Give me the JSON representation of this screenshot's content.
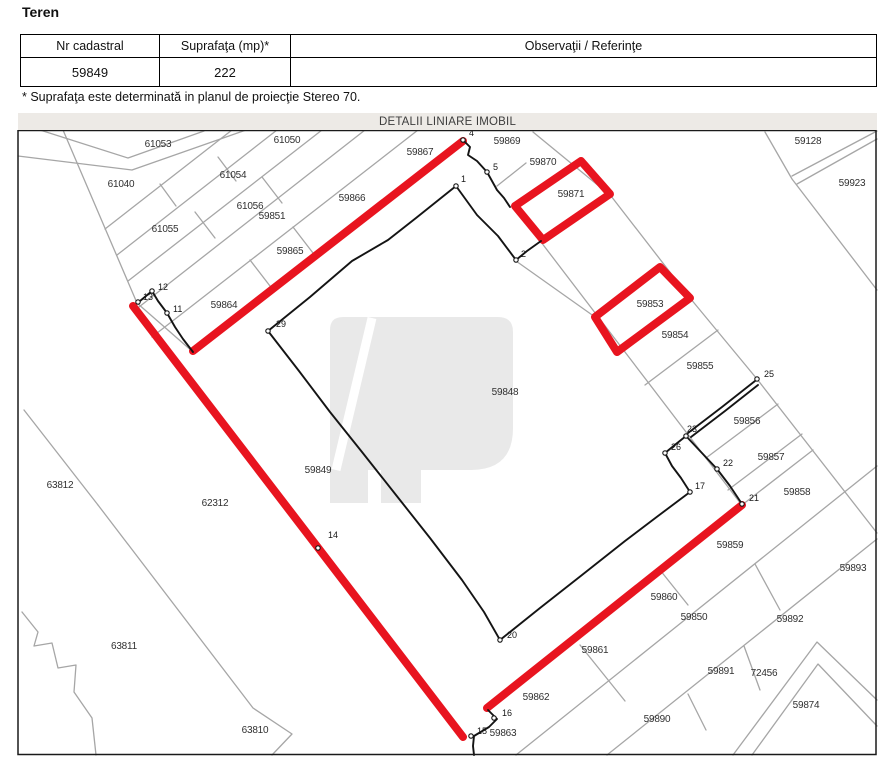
{
  "page": {
    "heading": "Teren"
  },
  "table": {
    "headers": [
      "Nr cadastral",
      "Suprafaţa (mp)*",
      "Observaţii / Referinţe"
    ],
    "row": {
      "nr_cadastral": "59849",
      "suprafata": "222",
      "observatii": ""
    }
  },
  "footnote": "* Suprafaţa este determinată in planul de proiecţie Stereo 70.",
  "map": {
    "title": "DETALII LINIARE IMOBIL",
    "colors": {
      "highlight_red": "#e8141f",
      "parcel_gray": "#a6a6a6",
      "boundary_black": "#141414",
      "label_color": "#303030",
      "watermark_gray": "#e9e9e9",
      "titlebar_bg": "#edeae6",
      "frame_black": "#1a1a1a"
    },
    "frame": {
      "x": 18,
      "y": 130,
      "w": 858,
      "h": 624
    },
    "watermark_path": "M330 503 L330 330 Q330 317 343 317 L498 317 Q513 317 513 332 L513 428 Q513 470 471 470 L421 470 L421 503 L381 503 L381 470 L368 470 L368 503 Z",
    "watermark_slash": [
      [
        336,
        470
      ],
      [
        372,
        318
      ]
    ],
    "gray_polylines": [
      [
        [
          18,
          156
        ],
        [
          132,
          170
        ],
        [
          246,
          130
        ]
      ],
      [
        [
          40,
          130
        ],
        [
          128,
          158
        ],
        [
          204,
          131
        ]
      ],
      [
        [
          63,
          130
        ],
        [
          137,
          303
        ],
        [
          193,
          352
        ]
      ],
      [
        [
          105,
          229
        ],
        [
          232,
          130
        ]
      ],
      [
        [
          117,
          255
        ],
        [
          277,
          130
        ]
      ],
      [
        [
          128,
          281
        ],
        [
          322,
          130
        ]
      ],
      [
        [
          139,
          307
        ],
        [
          365,
          130
        ]
      ],
      [
        [
          152,
          337
        ],
        [
          418,
          130
        ]
      ],
      [
        [
          293,
          227
        ],
        [
          313,
          253
        ]
      ],
      [
        [
          250,
          260
        ],
        [
          270,
          286
        ]
      ],
      [
        [
          262,
          177
        ],
        [
          282,
          203
        ]
      ],
      [
        [
          195,
          212
        ],
        [
          215,
          238
        ]
      ],
      [
        [
          218,
          157
        ],
        [
          236,
          181
        ]
      ],
      [
        [
          160,
          184
        ],
        [
          176,
          206
        ]
      ],
      [
        [
          765,
          132
        ],
        [
          792,
          179
        ],
        [
          877,
          290
        ]
      ],
      [
        [
          792,
          176
        ],
        [
          877,
          131
        ]
      ],
      [
        [
          797,
          184
        ],
        [
          877,
          139
        ]
      ],
      [
        [
          533,
          132
        ],
        [
          611,
          196
        ],
        [
          690,
          298
        ],
        [
          757,
          379
        ],
        [
          877,
          533
        ]
      ],
      [
        [
          541,
          242
        ],
        [
          741,
          504
        ]
      ],
      [
        [
          516,
          261
        ],
        [
          595,
          317
        ]
      ],
      [
        [
          497,
          186
        ],
        [
          526,
          163
        ]
      ],
      [
        [
          645,
          385
        ],
        [
          718,
          330
        ]
      ],
      [
        [
          706,
          458
        ],
        [
          778,
          404
        ]
      ],
      [
        [
          728,
          490
        ],
        [
          802,
          434
        ]
      ],
      [
        [
          742,
          505
        ],
        [
          813,
          450
        ]
      ],
      [
        [
          516,
          755
        ],
        [
          877,
          466
        ]
      ],
      [
        [
          607,
          755
        ],
        [
          877,
          539
        ]
      ],
      [
        [
          733,
          755
        ],
        [
          817,
          642
        ],
        [
          877,
          700
        ]
      ],
      [
        [
          752,
          755
        ],
        [
          818,
          664
        ],
        [
          877,
          726
        ]
      ],
      [
        [
          660,
          570
        ],
        [
          688,
          605
        ]
      ],
      [
        [
          755,
          564
        ],
        [
          780,
          610
        ]
      ],
      [
        [
          744,
          646
        ],
        [
          760,
          690
        ]
      ],
      [
        [
          580,
          645
        ],
        [
          625,
          701
        ]
      ],
      [
        [
          688,
          694
        ],
        [
          706,
          730
        ]
      ],
      [
        [
          24,
          410
        ],
        [
          98,
          505
        ]
      ],
      [
        [
          98,
          505
        ],
        [
          253,
          708
        ],
        [
          292,
          734
        ],
        [
          272,
          755
        ]
      ],
      [
        [
          22,
          612
        ],
        [
          38,
          632
        ],
        [
          34,
          646
        ],
        [
          52,
          643
        ],
        [
          58,
          668
        ],
        [
          76,
          665
        ],
        [
          74,
          692
        ],
        [
          92,
          718
        ],
        [
          96,
          755
        ]
      ]
    ],
    "black_polylines": [
      [
        [
          463,
          140
        ],
        [
          470,
          147
        ],
        [
          468,
          155
        ],
        [
          477,
          161
        ],
        [
          487,
          172
        ],
        [
          492,
          181
        ],
        [
          497,
          190
        ],
        [
          504,
          198
        ],
        [
          510,
          207
        ]
      ],
      [
        [
          541,
          241
        ],
        [
          527,
          251
        ],
        [
          516,
          260
        ]
      ],
      [
        [
          456,
          186
        ],
        [
          477,
          215
        ],
        [
          498,
          236
        ],
        [
          516,
          260
        ]
      ],
      [
        [
          456,
          186
        ],
        [
          416,
          218
        ],
        [
          388,
          240
        ],
        [
          352,
          261
        ],
        [
          310,
          297
        ],
        [
          268,
          331
        ]
      ],
      [
        [
          268,
          331
        ],
        [
          299,
          371
        ],
        [
          330,
          412
        ],
        [
          362,
          452
        ],
        [
          396,
          495
        ],
        [
          430,
          538
        ],
        [
          462,
          580
        ],
        [
          484,
          612
        ],
        [
          500,
          640
        ]
      ],
      [
        [
          500,
          640
        ],
        [
          540,
          608
        ],
        [
          582,
          575
        ],
        [
          625,
          541
        ],
        [
          658,
          516
        ],
        [
          690,
          492
        ]
      ],
      [
        [
          665,
          453
        ],
        [
          672,
          466
        ],
        [
          681,
          478
        ],
        [
          690,
          492
        ]
      ],
      [
        [
          665,
          453
        ],
        [
          676,
          444
        ],
        [
          686,
          436
        ]
      ],
      [
        [
          686,
          436
        ],
        [
          701,
          452
        ],
        [
          717,
          469
        ],
        [
          730,
          486
        ],
        [
          742,
          504
        ]
      ],
      [
        [
          688,
          433
        ],
        [
          722,
          407
        ],
        [
          755,
          381
        ]
      ],
      [
        [
          691,
          437
        ],
        [
          725,
          411
        ],
        [
          758,
          385
        ]
      ],
      [
        [
          140,
          301
        ],
        [
          152,
          291
        ],
        [
          158,
          301
        ],
        [
          167,
          313
        ],
        [
          175,
          327
        ],
        [
          183,
          339
        ],
        [
          193,
          352
        ]
      ],
      [
        [
          488,
          710
        ],
        [
          497,
          719
        ],
        [
          489,
          727
        ],
        [
          474,
          736
        ],
        [
          473,
          746
        ],
        [
          474,
          755
        ]
      ]
    ],
    "red_segments": [
      [
        [
          193,
          351
        ],
        [
          463,
          141
        ]
      ],
      [
        [
          133,
          306
        ],
        [
          463,
          737
        ]
      ],
      [
        [
          487,
          708
        ],
        [
          742,
          505
        ]
      ]
    ],
    "red_boxes": [
      [
        [
          515,
          206
        ],
        [
          581,
          161
        ],
        [
          610,
          194
        ],
        [
          543,
          240
        ]
      ],
      [
        [
          660,
          267
        ],
        [
          690,
          298
        ],
        [
          617,
          352
        ],
        [
          595,
          317
        ]
      ]
    ],
    "parcel_labels": [
      {
        "text": "61053",
        "x": 158,
        "y": 147
      },
      {
        "text": "61050",
        "x": 287,
        "y": 143
      },
      {
        "text": "59867",
        "x": 420,
        "y": 155
      },
      {
        "text": "59869",
        "x": 507,
        "y": 144
      },
      {
        "text": "59870",
        "x": 543,
        "y": 165
      },
      {
        "text": "59871",
        "x": 571,
        "y": 197
      },
      {
        "text": "59128",
        "x": 808,
        "y": 144
      },
      {
        "text": "59923",
        "x": 852,
        "y": 186
      },
      {
        "text": "61040",
        "x": 121,
        "y": 187
      },
      {
        "text": "61054",
        "x": 233,
        "y": 178
      },
      {
        "text": "61056",
        "x": 250,
        "y": 209
      },
      {
        "text": "59851",
        "x": 272,
        "y": 219
      },
      {
        "text": "59866",
        "x": 352,
        "y": 201
      },
      {
        "text": "61055",
        "x": 165,
        "y": 232
      },
      {
        "text": "59865",
        "x": 290,
        "y": 254
      },
      {
        "text": "59864",
        "x": 224,
        "y": 308
      },
      {
        "text": "59853",
        "x": 650,
        "y": 307
      },
      {
        "text": "59854",
        "x": 675,
        "y": 338
      },
      {
        "text": "59855",
        "x": 700,
        "y": 369
      },
      {
        "text": "59848",
        "x": 505,
        "y": 395
      },
      {
        "text": "59856",
        "x": 747,
        "y": 424
      },
      {
        "text": "59857",
        "x": 771,
        "y": 460
      },
      {
        "text": "59858",
        "x": 797,
        "y": 495
      },
      {
        "text": "59849",
        "x": 318,
        "y": 473
      },
      {
        "text": "62312",
        "x": 215,
        "y": 506
      },
      {
        "text": "63812",
        "x": 60,
        "y": 488
      },
      {
        "text": "59859",
        "x": 730,
        "y": 548
      },
      {
        "text": "59893",
        "x": 853,
        "y": 571
      },
      {
        "text": "59860",
        "x": 664,
        "y": 600
      },
      {
        "text": "59850",
        "x": 694,
        "y": 620
      },
      {
        "text": "59892",
        "x": 790,
        "y": 622
      },
      {
        "text": "63811",
        "x": 124,
        "y": 649
      },
      {
        "text": "59861",
        "x": 595,
        "y": 653
      },
      {
        "text": "59891",
        "x": 721,
        "y": 674
      },
      {
        "text": "72456",
        "x": 764,
        "y": 676
      },
      {
        "text": "59862",
        "x": 536,
        "y": 700
      },
      {
        "text": "59874",
        "x": 806,
        "y": 708
      },
      {
        "text": "59890",
        "x": 657,
        "y": 722
      },
      {
        "text": "63810",
        "x": 255,
        "y": 733
      },
      {
        "text": "59863",
        "x": 503,
        "y": 736
      }
    ],
    "point_labels": [
      {
        "text": "4",
        "x": 466,
        "y": 136,
        "mx": 463,
        "my": 140
      },
      {
        "text": "5",
        "x": 490,
        "y": 170,
        "mx": 487,
        "my": 172
      },
      {
        "text": "1",
        "x": 458,
        "y": 182,
        "mx": 456,
        "my": 186
      },
      {
        "text": "2",
        "x": 518,
        "y": 257,
        "mx": 516,
        "my": 260
      },
      {
        "text": "29",
        "x": 273,
        "y": 327,
        "mx": 268,
        "my": 331
      },
      {
        "text": "12",
        "x": 155,
        "y": 290,
        "mx": 152,
        "my": 291
      },
      {
        "text": "13",
        "x": 140,
        "y": 300,
        "mx": 138,
        "my": 302
      },
      {
        "text": "11",
        "x": 170,
        "y": 312,
        "mx": 167,
        "my": 313
      },
      {
        "text": "14",
        "x": 325,
        "y": 538,
        "mx": 318,
        "my": 548
      },
      {
        "text": "25",
        "x": 761,
        "y": 377,
        "mx": 757,
        "my": 379
      },
      {
        "text": "23",
        "x": 684,
        "y": 432,
        "mx": 686,
        "my": 436
      },
      {
        "text": "26",
        "x": 668,
        "y": 450,
        "mx": 665,
        "my": 453
      },
      {
        "text": "22",
        "x": 720,
        "y": 466,
        "mx": 717,
        "my": 469
      },
      {
        "text": "17",
        "x": 692,
        "y": 489,
        "mx": 690,
        "my": 492
      },
      {
        "text": "21",
        "x": 746,
        "y": 501,
        "mx": 742,
        "my": 504
      },
      {
        "text": "20",
        "x": 504,
        "y": 638,
        "mx": 500,
        "my": 640
      },
      {
        "text": "16",
        "x": 499,
        "y": 716,
        "mx": 494,
        "my": 718
      },
      {
        "text": "15",
        "x": 474,
        "y": 734,
        "mx": 471,
        "my": 736
      }
    ]
  }
}
